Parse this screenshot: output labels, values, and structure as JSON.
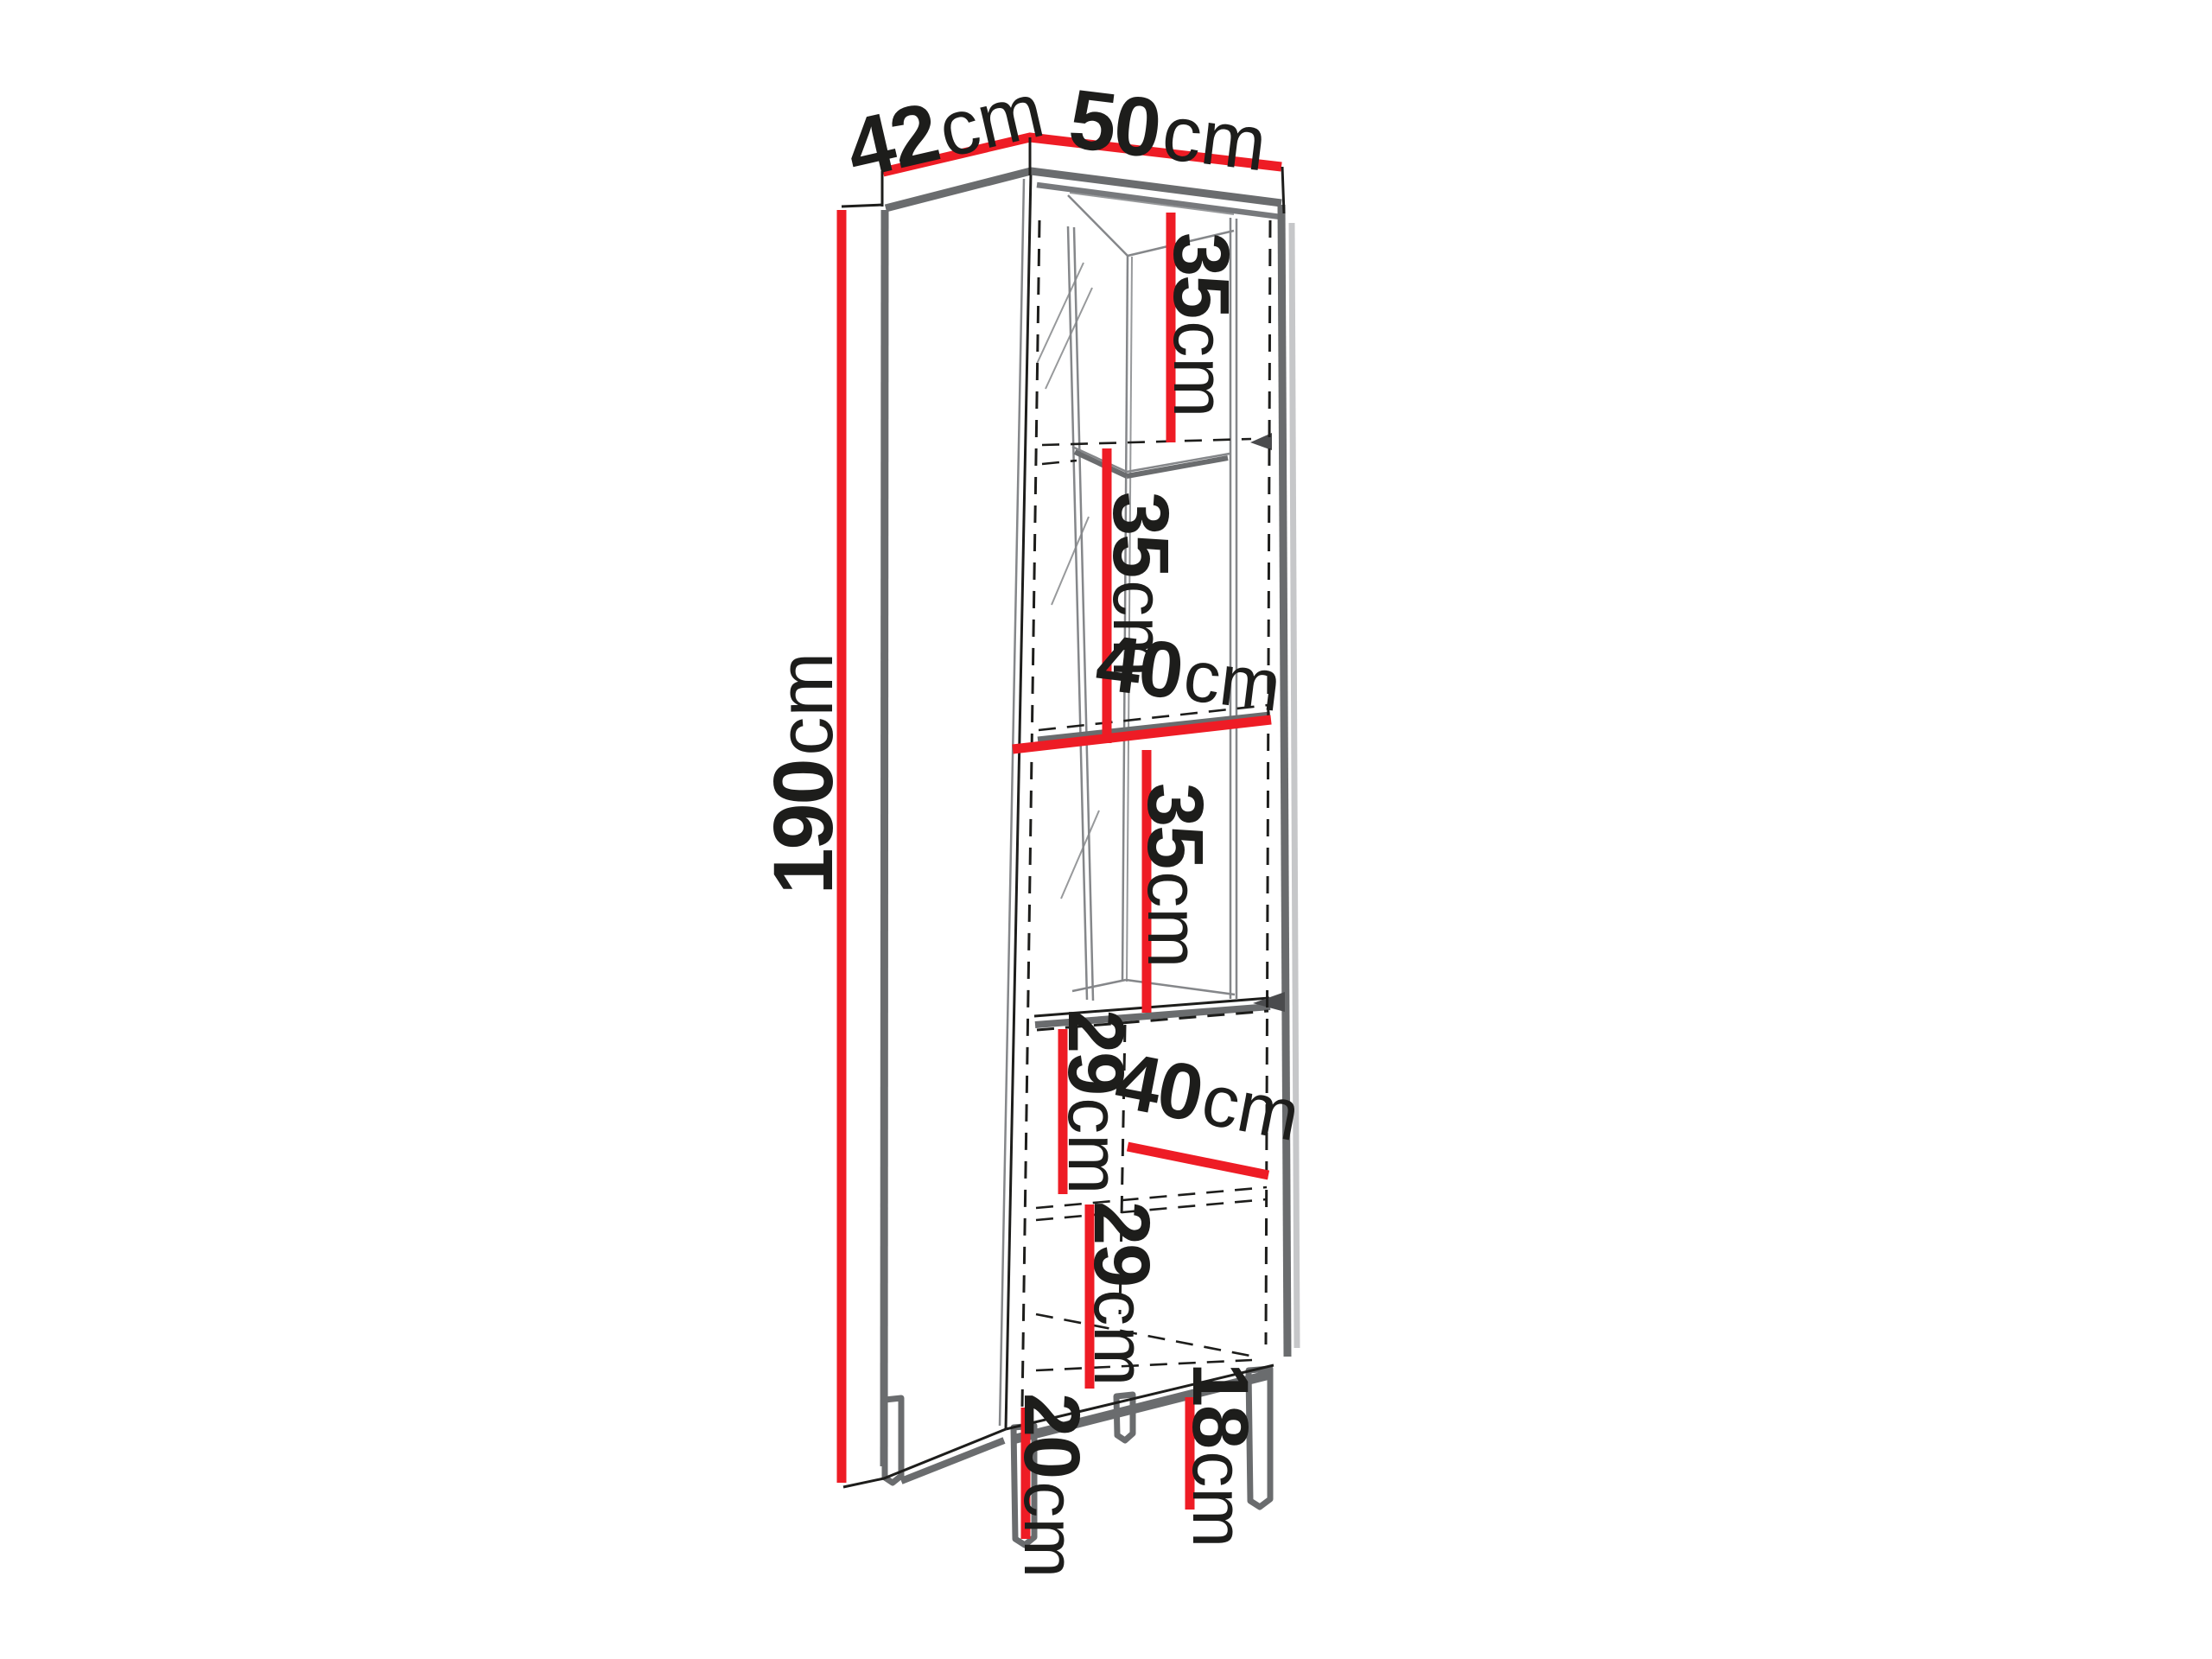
{
  "colors": {
    "bg": "#ffffff",
    "red": "#ee1c25",
    "ink": "#1d1d1b",
    "steel": "#6a6c6e",
    "steel-mid": "#77797c",
    "steel-thin": "#85878a",
    "shadow": "#c6c7c9",
    "arrow": "#4a4b4d"
  },
  "dims": {
    "depth": {
      "value": "42",
      "unit": "cm"
    },
    "width": {
      "value": "50",
      "unit": "cm"
    },
    "height": {
      "value": "190",
      "unit": "cm"
    },
    "shelf_top": {
      "value": "35",
      "unit": "cm"
    },
    "shelf_upper_mid": {
      "value": "35",
      "unit": "cm"
    },
    "inner_width": {
      "value": "40",
      "unit": "cm"
    },
    "shelf_lower_mid": {
      "value": "35",
      "unit": "cm"
    },
    "lower_section_top": {
      "value": "29",
      "unit": "cm"
    },
    "lower_depth": {
      "value": "40",
      "unit": "cm"
    },
    "lower_section_bottom": {
      "value": "29",
      "unit": "cm"
    },
    "front_leg": {
      "value": "20",
      "unit": "cm"
    },
    "side_leg": {
      "value": "18",
      "unit": "cm"
    }
  }
}
